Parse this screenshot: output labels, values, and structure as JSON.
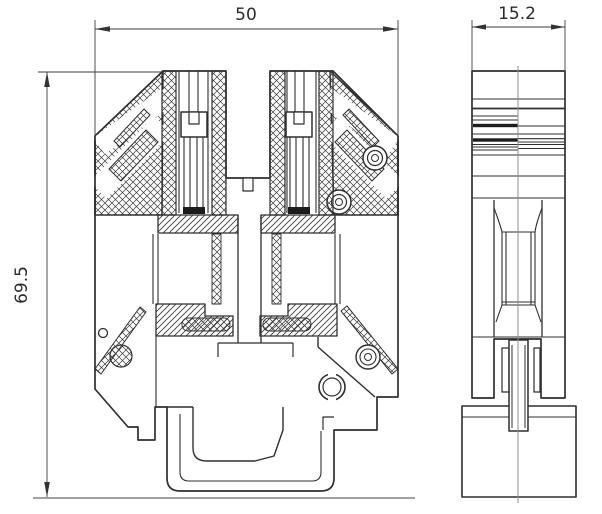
{
  "drawing": {
    "type": "technical-drawing",
    "subject": "DIN rail screw terminal block - sectional front view and side view",
    "dimensions": {
      "width": {
        "label": "50"
      },
      "depth": {
        "label": "15.2"
      },
      "height": {
        "label": "69.5"
      }
    },
    "views": {
      "front": {
        "name": "front-section-view"
      },
      "side": {
        "name": "side-view"
      }
    },
    "colors": {
      "ink": "#2f2f2f",
      "dimension": "#3d3d3d",
      "centerline": "#8f8f8f",
      "ground": "#6a6a6a",
      "background": "#ffffff"
    }
  }
}
